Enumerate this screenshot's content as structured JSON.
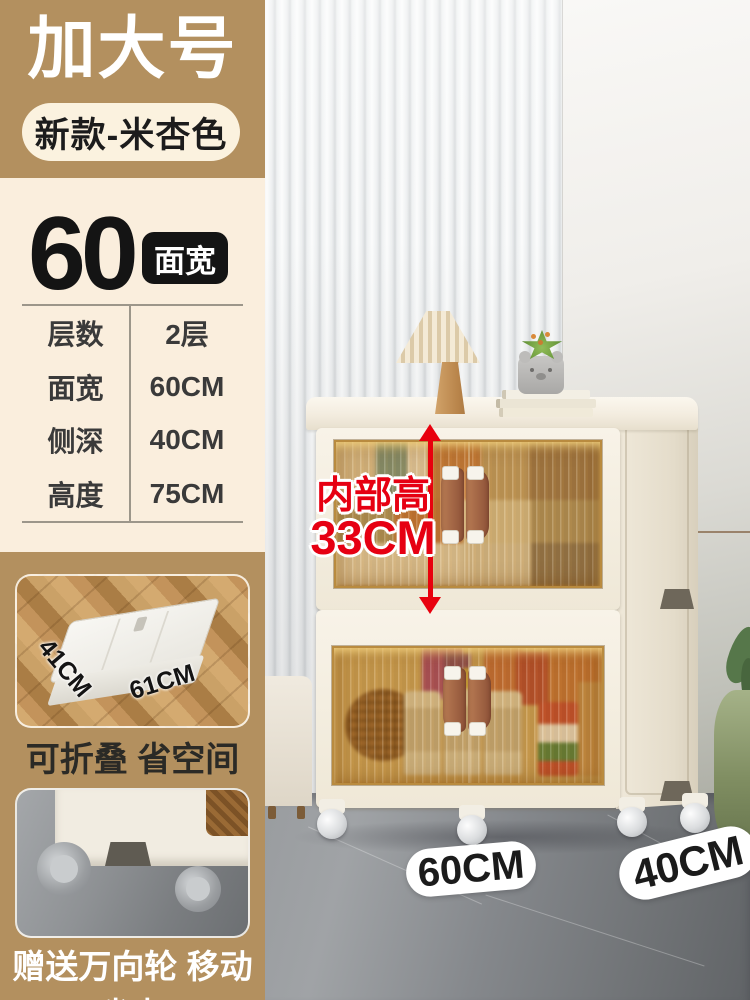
{
  "left_panel": {
    "size_title": "加大号",
    "variant_label": "新款-米杏色",
    "width_value": "60",
    "width_badge": "面宽",
    "spec_rows": [
      {
        "label": "层数",
        "value": "2层"
      },
      {
        "label": "面宽",
        "value": "60CM"
      },
      {
        "label": "侧深",
        "value": "40CM"
      },
      {
        "label": "高度",
        "value": "75CM"
      }
    ],
    "fold_photo": {
      "side_label": "41CM",
      "front_label": "61CM"
    },
    "fold_caption": "可折叠 省空间",
    "wheel_caption": "赠送万向轮 移动省力"
  },
  "scene": {
    "inner_height_line1": "内部高",
    "inner_height_line2": "33CM",
    "floor_width_label": "60CM",
    "floor_depth_label": "40CM"
  },
  "colors": {
    "tan_block": "#b3905f",
    "cream_panel": "#faeedd",
    "badge_black": "#141414",
    "accent_red": "#e60012",
    "cabinet_cream": "#f3ede2",
    "window_amber": "#c08a3e",
    "handle_brown": "#9c5f41",
    "floor_gray": "#8e9194"
  }
}
